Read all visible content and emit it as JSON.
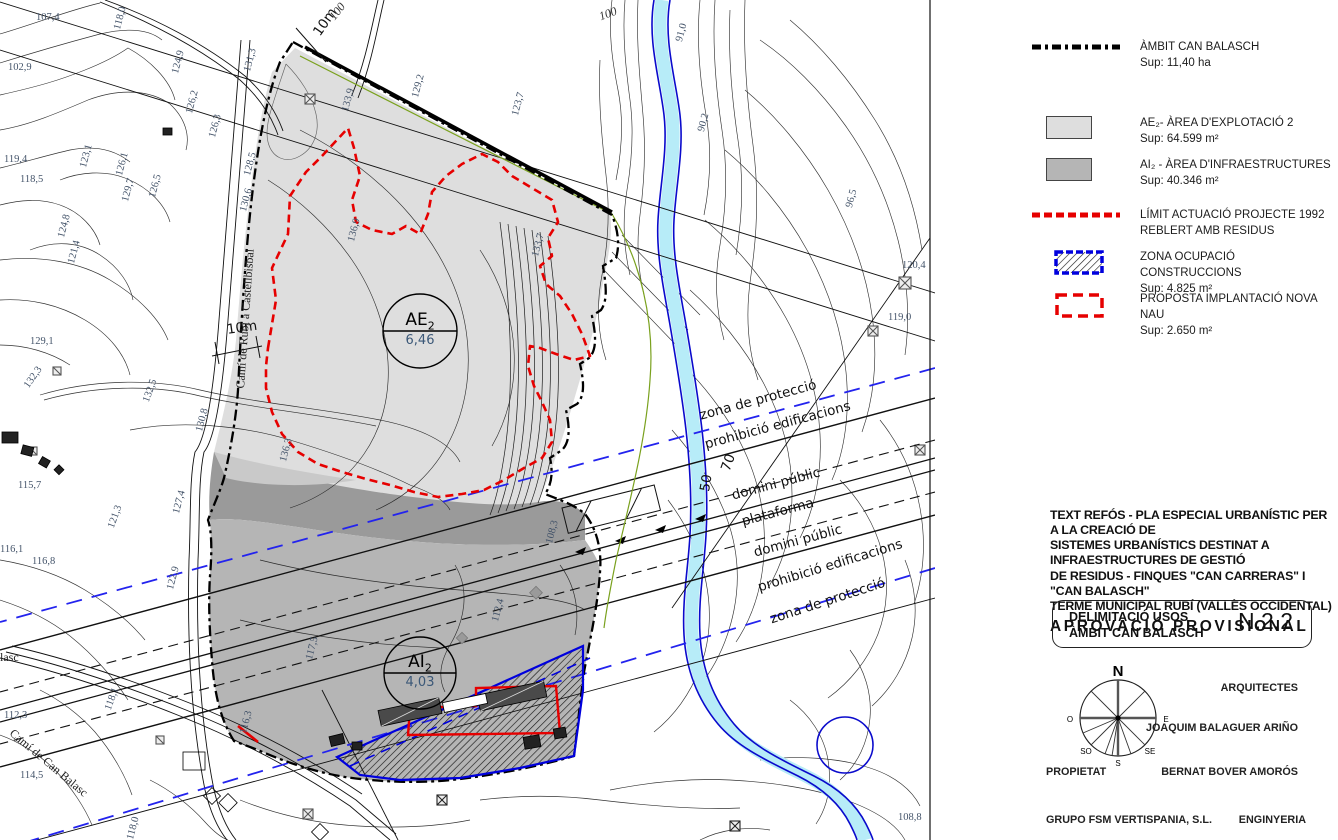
{
  "colors": {
    "ae2_fill": "#dedede",
    "band_fill": "#9a9a9a",
    "ai2_fill": "#b5b5b5",
    "limit_red": "#e60000",
    "zone_blue": "#0000dd",
    "protection_blue": "#2323ee",
    "river_fill": "#b7ecf8",
    "river_edge": "#0a0acc",
    "green_line": "#7aa11e"
  },
  "legend": {
    "items": [
      {
        "line1": "ÀMBIT CAN BALASCH",
        "line2": "Sup: 11,40 ha"
      },
      {
        "line1": "AE₂- ÀREA D'EXPLOTACIÓ 2",
        "line2": "Sup: 64.599 m²"
      },
      {
        "line1": "AI₂ - ÀREA D'INFRAESTRUCTURES",
        "line2": "Sup: 40.346 m²"
      },
      {
        "line1": "LÍMIT ACTUACIÓ PROJECTE 1992",
        "line2": "REBLERT AMB RESIDUS"
      },
      {
        "line1": "ZONA OCUPACIÓ CONSTRUCCIONS",
        "line2": "Sup: 4.825 m²"
      },
      {
        "line1": "PROPOSTA IMPLANTACIÓ NOVA NAU",
        "line2": "Sup: 2.650 m²"
      }
    ]
  },
  "title_block": {
    "line1": "TEXT REFÓS - PLA ESPECIAL URBANÍSTIC PER A LA CREACIÓ DE",
    "line2": "SISTEMES URBANÍSTICS DESTINAT A INFRAESTRUCTURES DE GESTIÓ",
    "line3": "DE RESIDUS - FINQUES \"CAN CARRERAS\" I \"CAN BALASCH\"",
    "line4": "TERME MUNICIPAL RUBÍ (VALLÈS OCCIDENTAL)",
    "approval": "APROVACIÓ PROVISIONAL"
  },
  "sheet": {
    "title_line1": "DELIMITACIÓ USOS",
    "title_line2": "ÀMBIT CAN BALASCH",
    "number": "N.2.2"
  },
  "compass": {
    "n": "N",
    "s": "S",
    "e": "E",
    "o": "O",
    "so": "SO",
    "se": "SE"
  },
  "credits": {
    "role_architects": "ARQUITECTES",
    "architect": "JOAQUIM BALAGUER ARIÑO",
    "role_property": "PROPIETAT",
    "owner": "BERNAT BOVER AMORÓS",
    "company": "GRUPO FSM VERTISPANIA, S.L.",
    "role_engineering": "ENGINYERIA"
  },
  "map": {
    "ae2": {
      "code": "AE",
      "sub": "2",
      "value": "6,46"
    },
    "ai2": {
      "code": "AI",
      "sub": "2",
      "value": "4,03"
    },
    "corridor_labels": [
      {
        "t": "zona de protecció",
        "x": 698,
        "y": 408,
        "r": -15
      },
      {
        "t": "prohibició edificacions",
        "x": 703,
        "y": 437,
        "r": -15
      },
      {
        "t": "domini públic",
        "x": 730,
        "y": 488,
        "r": -15
      },
      {
        "t": "plataforma",
        "x": 740,
        "y": 514,
        "r": -15
      },
      {
        "t": "domini públic",
        "x": 752,
        "y": 545,
        "r": -15
      },
      {
        "t": "prohibició edificacions",
        "x": 756,
        "y": 580,
        "r": -17
      },
      {
        "t": "zona de protecció",
        "x": 768,
        "y": 612,
        "r": -18
      },
      {
        "t": "50",
        "x": 697,
        "y": 490,
        "r": -80
      },
      {
        "t": "70",
        "x": 718,
        "y": 468,
        "r": -70
      },
      {
        "t": "10m",
        "x": 226,
        "y": 322,
        "r": -8
      },
      {
        "t": "10m",
        "x": 310,
        "y": 30,
        "r": -55
      }
    ],
    "road_labels": [
      {
        "t": "Camí de Rubí a Castellbisbal",
        "x": 233,
        "y": 388,
        "r": -86
      },
      {
        "t": "Camí de Can Balasc",
        "x": 16,
        "y": 726,
        "r": 40
      },
      {
        "t": "lasc",
        "x": 0,
        "y": 650,
        "r": 0
      }
    ],
    "contour_labels": [
      {
        "t": "100",
        "x": 326,
        "y": 14,
        "r": -52
      },
      {
        "t": "100",
        "x": 597,
        "y": 10,
        "r": -20
      }
    ],
    "elevation_labels": [
      {
        "t": "107,4",
        "x": 36,
        "y": 12,
        "r": 0
      },
      {
        "t": "102,9",
        "x": 8,
        "y": 62,
        "r": 0
      },
      {
        "t": "118,0",
        "x": 112,
        "y": 28,
        "r": -75
      },
      {
        "t": "124,9",
        "x": 170,
        "y": 72,
        "r": -75
      },
      {
        "t": "131,3",
        "x": 242,
        "y": 70,
        "r": -75
      },
      {
        "t": "126,2",
        "x": 184,
        "y": 112,
        "r": -75
      },
      {
        "t": "126,3",
        "x": 207,
        "y": 136,
        "r": -75
      },
      {
        "t": "128,5",
        "x": 242,
        "y": 174,
        "r": -75
      },
      {
        "t": "130,6",
        "x": 238,
        "y": 210,
        "r": -75
      },
      {
        "t": "119,4",
        "x": 4,
        "y": 154,
        "r": 0
      },
      {
        "t": "118,5",
        "x": 20,
        "y": 174,
        "r": 0
      },
      {
        "t": "123,1",
        "x": 78,
        "y": 166,
        "r": -75
      },
      {
        "t": "126,1",
        "x": 114,
        "y": 174,
        "r": -75
      },
      {
        "t": "129,7",
        "x": 120,
        "y": 200,
        "r": -75
      },
      {
        "t": "126,5",
        "x": 147,
        "y": 196,
        "r": -75
      },
      {
        "t": "124,8",
        "x": 56,
        "y": 236,
        "r": -75
      },
      {
        "t": "121,4",
        "x": 66,
        "y": 262,
        "r": -75
      },
      {
        "t": "129,1",
        "x": 30,
        "y": 336,
        "r": 0
      },
      {
        "t": "132,3",
        "x": 22,
        "y": 384,
        "r": -55
      },
      {
        "t": "132,5",
        "x": 141,
        "y": 400,
        "r": -70
      },
      {
        "t": "130,8",
        "x": 194,
        "y": 430,
        "r": -75
      },
      {
        "t": "115,7",
        "x": 18,
        "y": 480,
        "r": 0
      },
      {
        "t": "116,1",
        "x": 0,
        "y": 544,
        "r": 0
      },
      {
        "t": "116,8",
        "x": 32,
        "y": 556,
        "r": 0
      },
      {
        "t": "121,3",
        "x": 106,
        "y": 526,
        "r": -70
      },
      {
        "t": "122,9",
        "x": 165,
        "y": 588,
        "r": -75
      },
      {
        "t": "127,4",
        "x": 171,
        "y": 512,
        "r": -75
      },
      {
        "t": "133,9",
        "x": 340,
        "y": 110,
        "r": -75
      },
      {
        "t": "129,2",
        "x": 410,
        "y": 96,
        "r": -75
      },
      {
        "t": "123,7",
        "x": 510,
        "y": 114,
        "r": -75
      },
      {
        "t": "136,9",
        "x": 346,
        "y": 240,
        "r": -75
      },
      {
        "t": "133,7",
        "x": 530,
        "y": 255,
        "r": -75
      },
      {
        "t": "136,3",
        "x": 278,
        "y": 460,
        "r": -75
      },
      {
        "t": "91,0",
        "x": 674,
        "y": 40,
        "r": -75
      },
      {
        "t": "90,2",
        "x": 696,
        "y": 130,
        "r": -75
      },
      {
        "t": "96,5",
        "x": 844,
        "y": 206,
        "r": -75
      },
      {
        "t": "120,4",
        "x": 902,
        "y": 260,
        "r": 0
      },
      {
        "t": "119,0",
        "x": 888,
        "y": 312,
        "r": 0
      },
      {
        "t": "108,3",
        "x": 544,
        "y": 542,
        "r": -75
      },
      {
        "t": "112,4",
        "x": 490,
        "y": 620,
        "r": -75
      },
      {
        "t": "117,5",
        "x": 304,
        "y": 658,
        "r": -75
      },
      {
        "t": "116,3",
        "x": 238,
        "y": 732,
        "r": -75
      },
      {
        "t": "112,3",
        "x": 4,
        "y": 710,
        "r": 0
      },
      {
        "t": "114,5",
        "x": 20,
        "y": 770,
        "r": 0
      },
      {
        "t": "118,1",
        "x": 103,
        "y": 708,
        "r": -70
      },
      {
        "t": "118,0",
        "x": 125,
        "y": 838,
        "r": -75
      },
      {
        "t": "108,8",
        "x": 898,
        "y": 812,
        "r": 0
      }
    ]
  }
}
